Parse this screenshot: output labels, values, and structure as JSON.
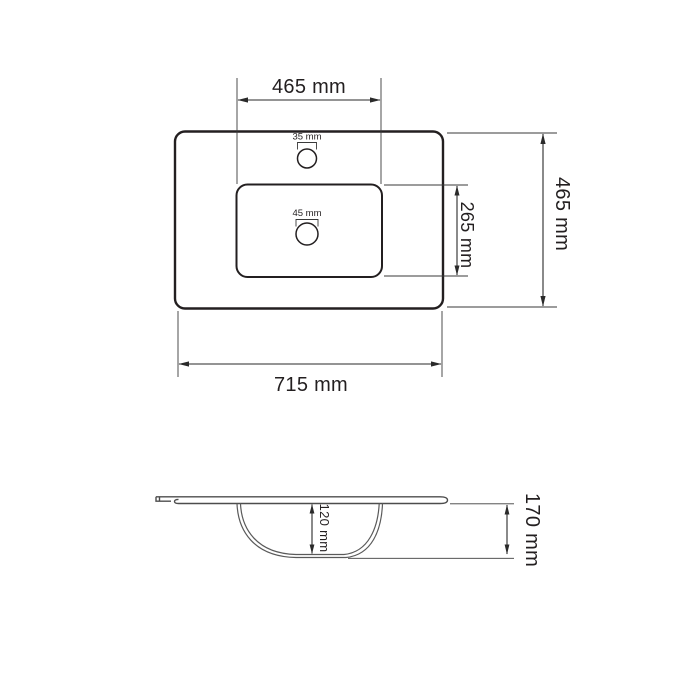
{
  "drawing": {
    "kind": "washbasin-technical-drawing",
    "top_view": {
      "basin_cutout_width_label": "465 mm",
      "faucet_hole_diameter_label": "35 mm",
      "drain_hole_diameter_label": "45 mm",
      "basin_cutout_depth_label": "265 mm",
      "overall_depth_label": "465 mm",
      "overall_width_label": "715 mm"
    },
    "side_view": {
      "bowl_inner_depth_label": "120 mm",
      "overall_height_label": "170 mm"
    },
    "colors": {
      "outline": "#231f20",
      "dimension_line": "#2a2a2a",
      "side_profile_line": "#4d4d4d",
      "background": "#ffffff"
    }
  }
}
